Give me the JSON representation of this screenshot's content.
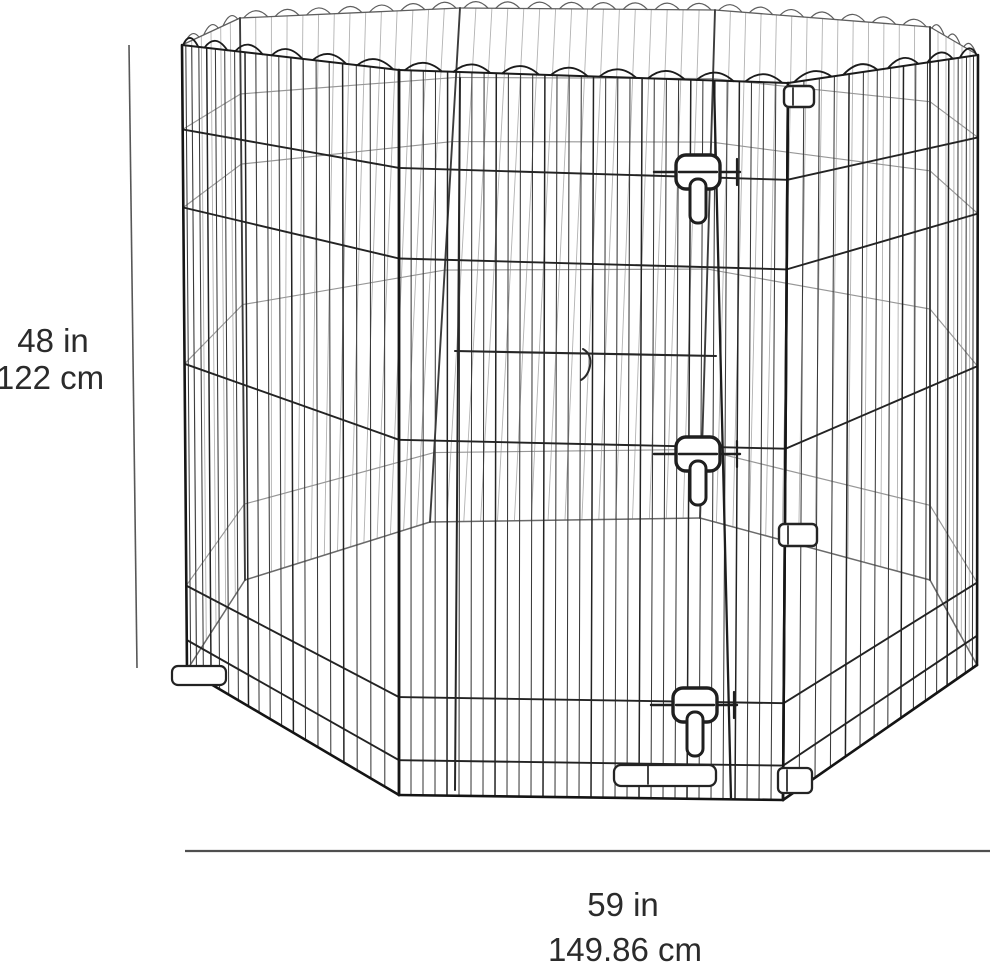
{
  "illustration": {
    "alt": "Octagonal folding metal wire pet exercise pen with walk-through door, three flip latches, corner clips and ground anchors",
    "panel_count_visible_front": 3,
    "panel_count_total": 8,
    "latch_count": 3
  },
  "dimensions": {
    "height": {
      "in": "48 in",
      "cm": "122 cm"
    },
    "width": {
      "in": "59 in",
      "cm": "149.86 cm"
    }
  },
  "colors": {
    "background": "#ffffff",
    "wire_front": "#2d2d2d",
    "wire_back": "#9c9c9c",
    "frame_edge": "#161616",
    "dimension_line": "#4f4f4f",
    "label_text": "#2b2b2b"
  }
}
